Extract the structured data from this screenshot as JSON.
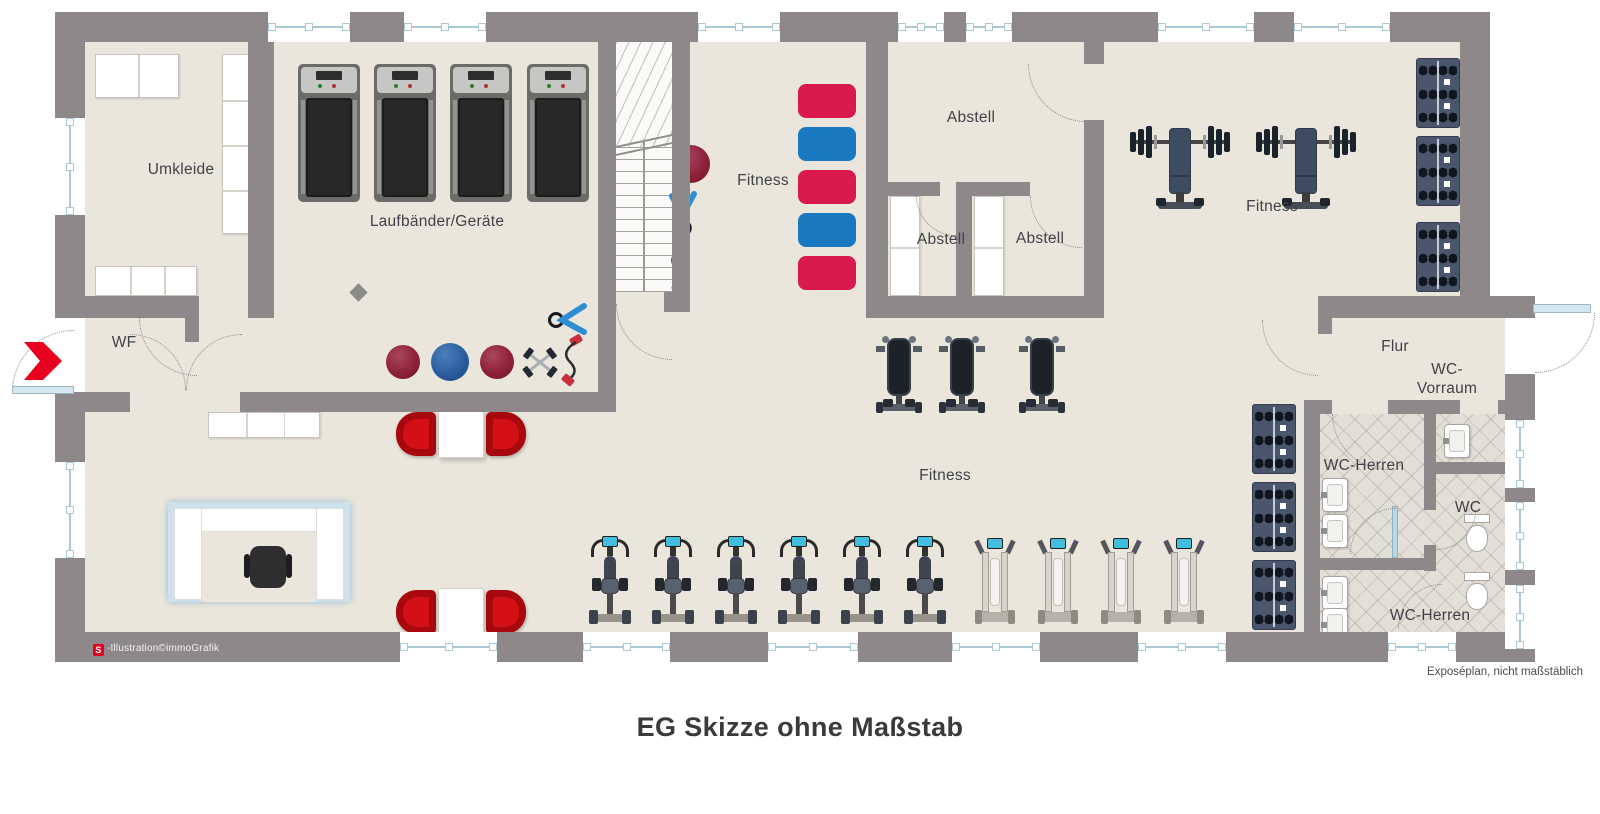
{
  "title": "EG Skizze ohne Maßstab",
  "plan": {
    "rooms": {
      "umkleide": "Umkleide",
      "laufbaender": "Laufbänder/Geräte",
      "fitness_mats": "Fitness",
      "abstell_main": "Abstell",
      "abstell_left": "Abstell",
      "abstell_right": "Abstell",
      "fitness_weights": "Fitness",
      "wf": "WF",
      "fitness_main": "Fitness",
      "flur": "Flur",
      "wc_vorraum_line1": "WC-",
      "wc_vorraum_line2": "Vorraum",
      "wc_herren_upper": "WC-Herren",
      "wc": "WC",
      "wc_herren_lower": "WC-Herren"
    },
    "equipment_counts": {
      "treadmills": 4,
      "exercise_mats": 5,
      "exercise_balls": 4,
      "weight_benches": 3,
      "barbell_stations": 2,
      "dumbbell_racks": 6,
      "exercise_bikes": 6,
      "cross_trainers": 4,
      "visitor_tables": 2,
      "reception_desks": 1
    },
    "colors": {
      "wall": "#8f888b",
      "floor": "#eae6dc",
      "tile_floor": "#e3dfd7",
      "mat_red": "#da1a4a",
      "mat_blue": "#1879c0",
      "chair_red": "#d31016",
      "arrow_red": "#e8001e",
      "window_glass": "#a9c9d6"
    }
  },
  "footer": {
    "credit_logo": "S",
    "credit_text": "-Illustration©immoGrafik",
    "disclaimer": "Exposéplan, nicht maßstäblich"
  }
}
